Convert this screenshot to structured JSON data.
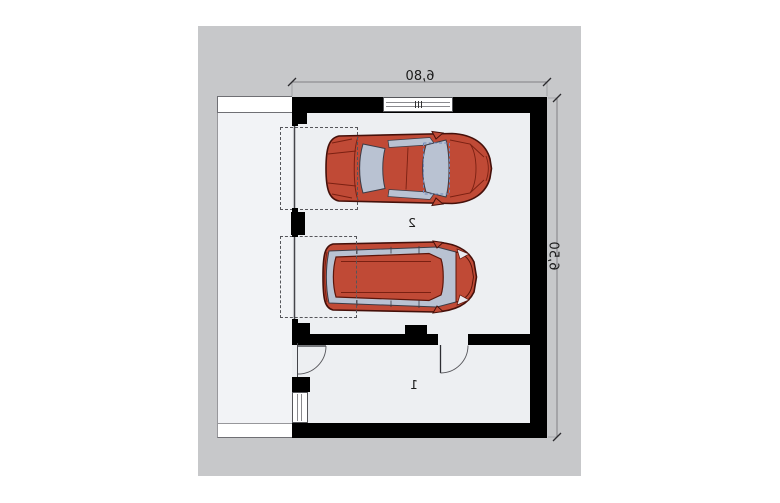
{
  "title": "Garage floor plan (mirrored print)",
  "plan": {
    "dimension_width": {
      "label": "6,80"
    },
    "dimension_height": {
      "label": "6,50"
    },
    "rooms": [
      {
        "number": "1"
      },
      {
        "number": "2"
      }
    ],
    "cars": [
      {
        "name": "sedan-top-view",
        "body_color": "#c04a36",
        "glass_color": "#b9c2d2"
      },
      {
        "name": "wagon-top-view",
        "body_color": "#c04a36",
        "glass_color": "#b9c2d2"
      }
    ],
    "colors": {
      "canvas_background": "#c7c8ca",
      "interior_floor": "#edeff2",
      "apron": "#f2f3f6",
      "walls": "#000000",
      "parking_dash": "#55555a",
      "dimension_line": "#808084",
      "car_body": "#c04a36",
      "car_glass": "#b9c2d2"
    }
  }
}
